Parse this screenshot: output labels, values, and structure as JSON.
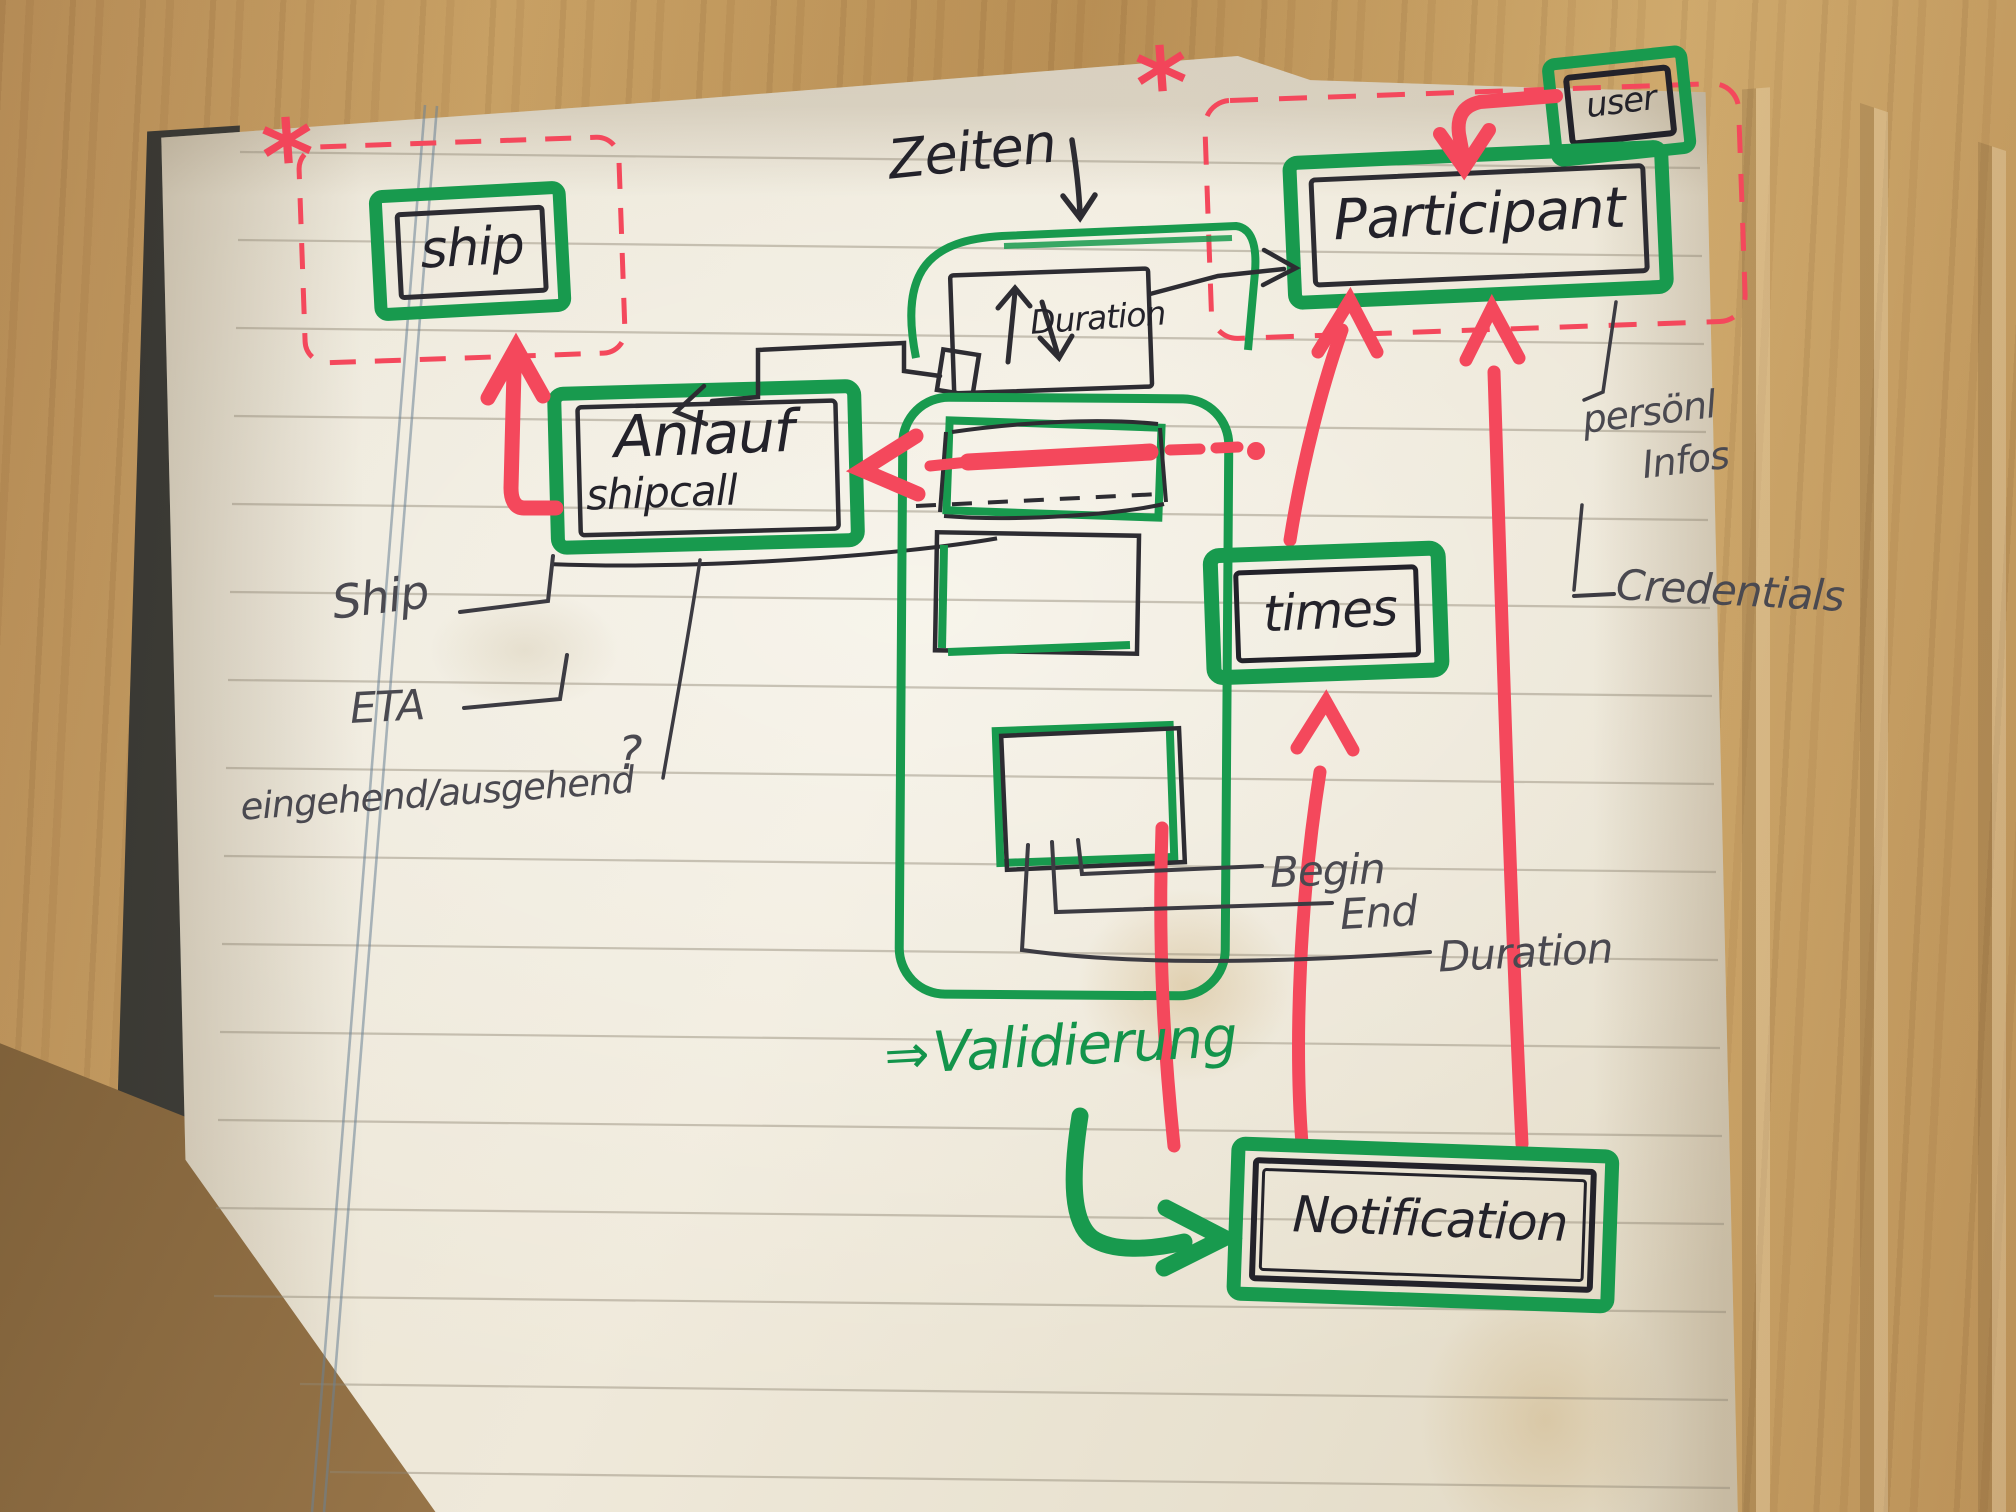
{
  "scene": {
    "description": "hand-drawn data-model sketch on a ruled notebook page photographed on a wooden desk"
  },
  "colors": {
    "marker_green": "#189a4e",
    "marker_red": "#f4485c",
    "ink_black": "#2d2c32",
    "pencil_gray": "#4a4950",
    "paper": "#e9e3d6"
  },
  "entities": {
    "ship": {
      "label": "ship"
    },
    "user": {
      "label": "user"
    },
    "participant": {
      "label": "Participant"
    },
    "anlauf": {
      "label": "Anlauf",
      "sublabel": "shipcall"
    },
    "duration_box": {
      "label": "Duration"
    },
    "times": {
      "label": "times"
    },
    "notification": {
      "label": "Notification"
    }
  },
  "annotations": {
    "zeiten": "Zeiten",
    "ship_attr": "Ship",
    "eta": "ETA",
    "inout": "eingehend/ausgehend",
    "question_mark": "?",
    "begin": "Begin",
    "end": "End",
    "duration_attr": "Duration",
    "persoenl": "persönl",
    "infos": "Infos",
    "credentials": "Credentials",
    "validierung_arrow": "⇒",
    "validierung": "Validierung",
    "asterisk": "*"
  }
}
